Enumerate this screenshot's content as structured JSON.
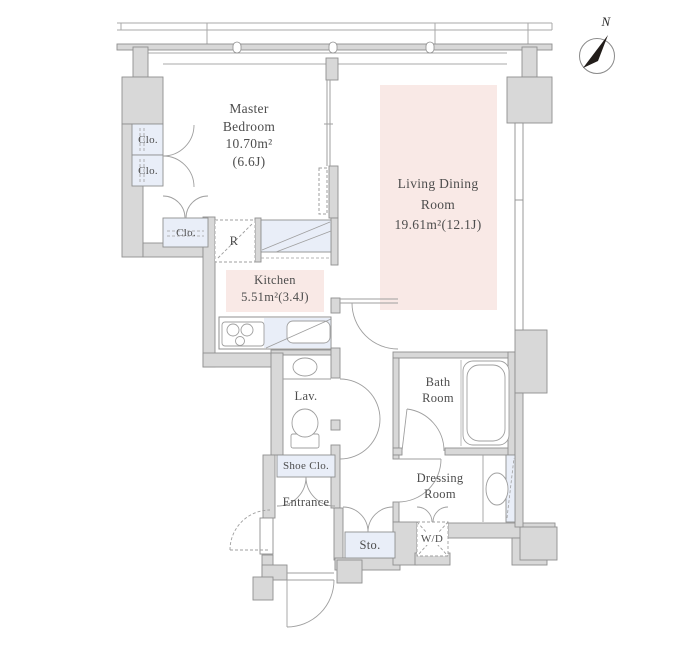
{
  "compass": {
    "north_label": "N"
  },
  "rooms": {
    "master_bedroom": {
      "line1": "Master",
      "line2": "Bedroom",
      "area": "10.70m²",
      "tatami": "(6.6J)"
    },
    "living_dining": {
      "line1": "Living Dining",
      "line2": "Room",
      "area": "19.61m²(12.1J)"
    },
    "kitchen": {
      "name": "Kitchen",
      "area": "5.51m²(3.4J)"
    },
    "bath": {
      "line1": "Bath",
      "line2": "Room"
    },
    "dressing": {
      "line1": "Dressing",
      "line2": "Room"
    },
    "lavatory": {
      "name": "Lav."
    },
    "entrance": {
      "name": "Entrance"
    },
    "shoe_closet": {
      "name": "Shoe Clo."
    },
    "storage": {
      "name": "Sto."
    },
    "washer_dryer": {
      "name": "W/D"
    },
    "refrigerator": {
      "name": "R"
    },
    "closet_upper": {
      "name": "Clo."
    },
    "closet_lower": {
      "name": "Clo."
    },
    "closet_hall": {
      "name": "Clo."
    }
  },
  "colors": {
    "wall_fill": "#d8d8d8",
    "wall_stroke": "#8f8f8f",
    "fixture_fill": "#e9eef8",
    "area_tint": "#f9e9e6",
    "line": "#9f9f9f",
    "text": "#4d4d4d",
    "compass_needle": "#221d1a"
  }
}
